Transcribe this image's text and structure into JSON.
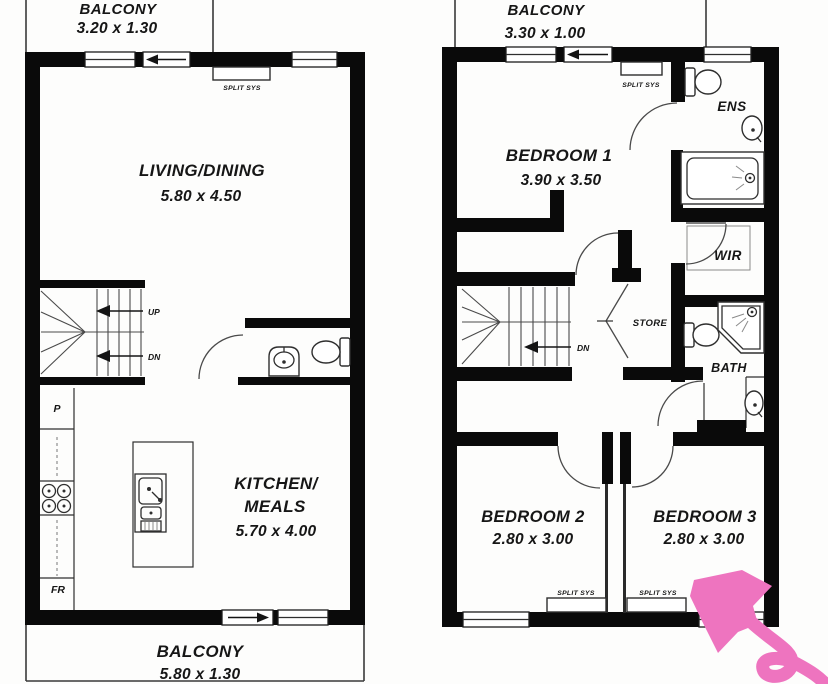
{
  "title": "Two-storey townhouse floor plan",
  "colors": {
    "wall": "#0a0a0a",
    "text": "#161616",
    "annotation_arrow": "#ee74bf",
    "background": "#fdfdfc"
  },
  "floor1": {
    "balcony_top": {
      "name": "BALCONY",
      "dim": "3.20 x 1.30"
    },
    "split_sys": "SPLIT SYS",
    "living": {
      "name": "LIVING/DINING",
      "dim": "5.80 x 4.50"
    },
    "up": "UP",
    "dn": "DN",
    "pantry": "P",
    "fridge": "FR",
    "kitchen": {
      "line1": "KITCHEN/",
      "line2": "MEALS",
      "dim": "5.70 x 4.00"
    },
    "balcony_bottom": {
      "name": "BALCONY",
      "dim": "5.80 x 1.30"
    }
  },
  "floor2": {
    "balcony": {
      "name": "BALCONY",
      "dim": "3.30 x 1.00"
    },
    "split_sys_top": "SPLIT SYS",
    "bedroom1": {
      "name": "BEDROOM 1",
      "dim": "3.90 x 3.50"
    },
    "ens": "ENS",
    "wir": "WIR",
    "dn": "DN",
    "store": "STORE",
    "bath": "BATH",
    "bedroom2": {
      "name": "BEDROOM 2",
      "dim": "2.80 x 3.00",
      "split": "SPLIT SYS"
    },
    "bedroom3": {
      "name": "BEDROOM 3",
      "dim": "2.80 x 3.00",
      "split": "SPLIT SYS"
    }
  }
}
